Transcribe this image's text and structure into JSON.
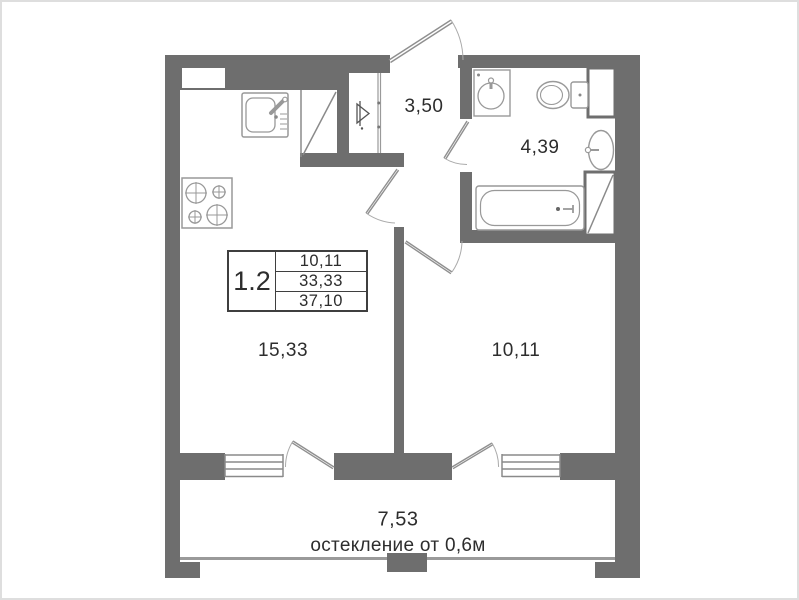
{
  "plan": {
    "title_block": {
      "unit": "1.2",
      "values": [
        "10,11",
        "33,33",
        "37,10"
      ]
    },
    "rooms": {
      "hallway": {
        "area": "3,50"
      },
      "bathroom": {
        "area": "4,39"
      },
      "kitchen_living": {
        "area": "15,33"
      },
      "bedroom": {
        "area": "10,11"
      },
      "balcony": {
        "area": "7,53",
        "note": "остекление от 0,6м"
      }
    },
    "colors": {
      "wall": "#6e6e6e",
      "thin_line": "#9a9a9a",
      "fixture_line": "#999999",
      "text": "#2d2d2d"
    }
  }
}
